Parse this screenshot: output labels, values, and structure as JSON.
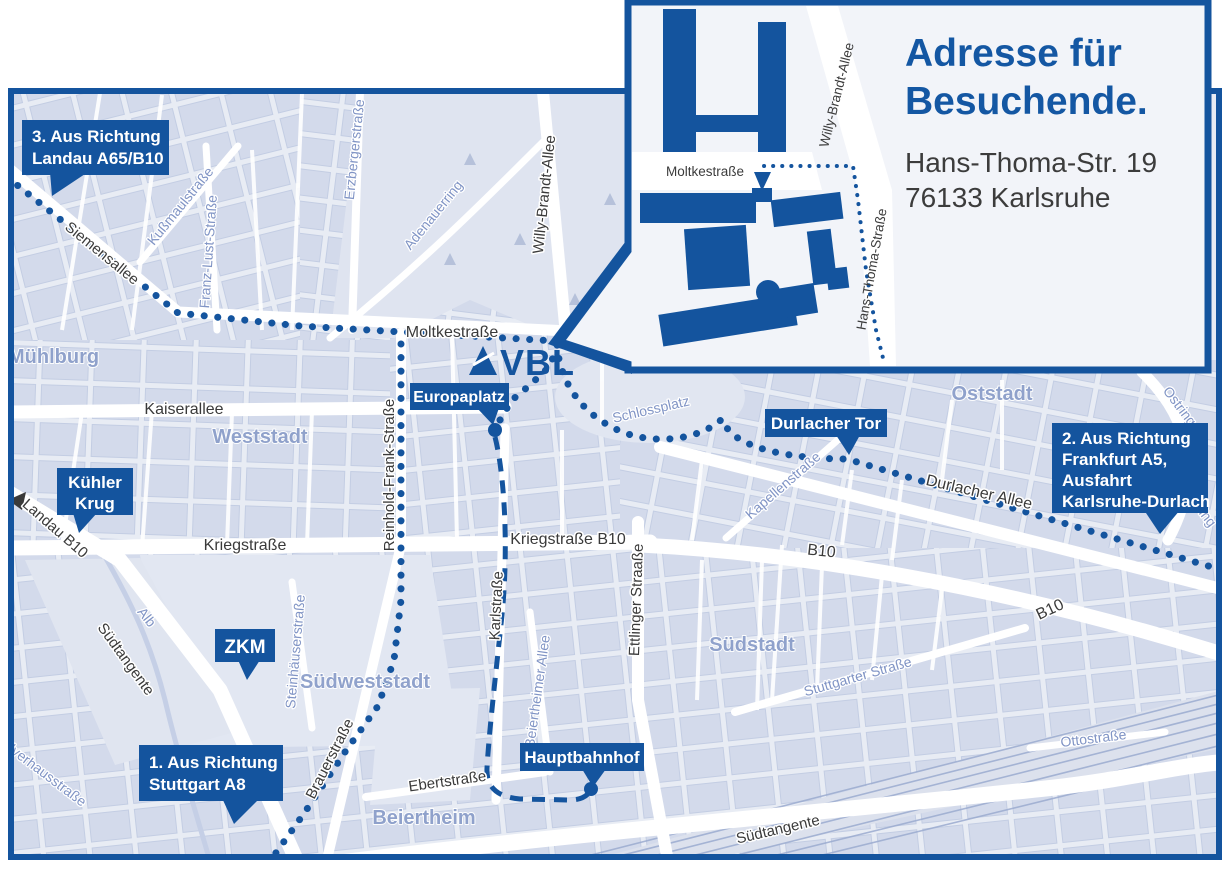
{
  "colors": {
    "accent": "#14549e",
    "map_background": "#e8ecf4",
    "block_fill": "#d3daeb",
    "park_fill": "#dfe4f0",
    "minor_label": "#8094c5",
    "district_label": "#8c9fca",
    "dark_label": "#3a3a3a",
    "white": "#ffffff"
  },
  "logo": {
    "text": "VBL"
  },
  "badges": {
    "landau": {
      "lines": [
        "3. Aus Richtung",
        "Landau A65/B10"
      ]
    },
    "frankfurt": {
      "lines": [
        "2. Aus Richtung",
        "Frankfurt A5,",
        "Ausfahrt",
        "Karlsruhe-Durlach"
      ]
    },
    "stuttgart": {
      "lines": [
        "1. Aus Richtung",
        "Stuttgart A8"
      ]
    },
    "kuehler_krug": {
      "lines": [
        "Kühler",
        "Krug"
      ]
    },
    "zkm": {
      "lines": [
        "ZKM"
      ]
    },
    "europaplatz": {
      "lines": [
        "Europaplatz"
      ]
    },
    "durlacher_tor": {
      "lines": [
        "Durlacher Tor"
      ]
    },
    "hauptbahnhof": {
      "lines": [
        "Hauptbahnhof"
      ]
    }
  },
  "streets": {
    "siemensallee": "Siemensallee",
    "moltkestrasse": "Moltkestraße",
    "kaiserallee": "Kaiserallee",
    "kriegstrasse": "Kriegstraße",
    "kriegstrasse_b10": "Kriegstraße B10",
    "b10_mid": "B10",
    "b10_east": "B10",
    "reinhold_frank": "Reinhold-Frank-Straße",
    "karlstrasse": "Karlstraße",
    "ettlinger": "Ettlinger Straaße",
    "willy_brandt": "Willy-Brandt-Allee",
    "brauerstrasse": "Brauerstraße",
    "ebertstrasse": "Ebertstraße",
    "durlacher_allee": "Durlacher Allee",
    "suedtangente_west": "Südtangente",
    "suedtangente_sued": "Südtangente",
    "landau_b10": "Landau B10"
  },
  "minor_streets": {
    "kussmaul": "Kußmaulstraße",
    "franz_lust": "Franz-Lust-Straße",
    "erzberger": "Erzbergerstraße",
    "adenauerring": "Adenauerring",
    "schlossplatz": "Schlossplatz",
    "kapellenstrasse": "Kapellenstraße",
    "steinhaeuser": "Steinhäuserstraße",
    "beiertheimer": "Beiertheimer Allee",
    "stuttgarter": "Stuttgarter Straße",
    "ostring_nord": "Ostring",
    "ostring_sued": "Ostring",
    "ottostrasse": "Ottostraße",
    "alb": "Alb",
    "pulverhaus": "Pulverhausstraße"
  },
  "districts": {
    "muehlburg": "Mühlburg",
    "weststadt": "Weststadt",
    "oststadt": "Oststadt",
    "suedstadt": "Südstadt",
    "suedweststadt": "Südweststadt",
    "beiertheim": "Beiertheim"
  },
  "inset": {
    "heading": {
      "line1": "Adresse für",
      "line2": "Besuchende."
    },
    "address": {
      "line1": "Hans-Thoma-Str. 19",
      "line2": "76133 Karlsruhe"
    },
    "labels": {
      "moltkestrasse": "Moltkestraße",
      "willy_brandt_allee": "Willy-Brandt-Allee",
      "hans_thoma_strasse": "Hans-Thoma-Straße"
    }
  }
}
